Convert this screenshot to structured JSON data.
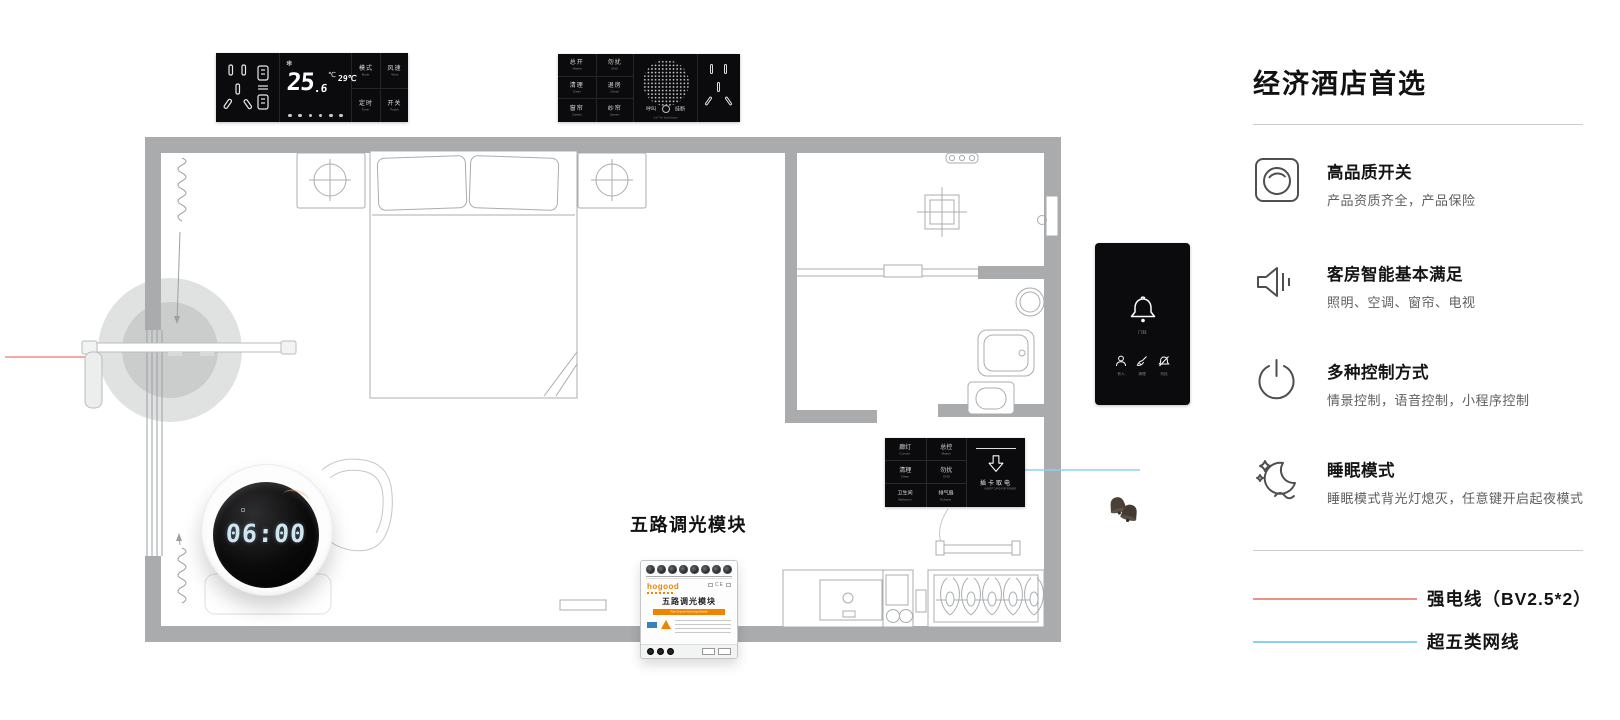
{
  "sidebar": {
    "title": "经济酒店首选",
    "features": [
      {
        "icon": "knob-switch-icon",
        "title": "高品质开关",
        "subtitle": "产品资质齐全，产品保险"
      },
      {
        "icon": "speaker-icon",
        "title": "客房智能基本满足",
        "subtitle": "照明、空调、窗帘、电视"
      },
      {
        "icon": "power-icon",
        "title": "多种控制方式",
        "subtitle": "情景控制，语音控制，小程序控制"
      },
      {
        "icon": "moon-stars-icon",
        "title": "睡眠模式",
        "subtitle": "睡眠模式背光灯熄灭，任意键开启起夜模式"
      }
    ],
    "legend": [
      {
        "label": "强电线（BV2.5*2）",
        "color": "#ef9086"
      },
      {
        "label": "超五类网线",
        "color": "#8fd0ea"
      }
    ]
  },
  "thermostat_panel": {
    "set_temp": "25",
    "set_temp_frac": ".6",
    "unit": "℃",
    "ambient": "29℃",
    "buttons": [
      {
        "zh": "模式",
        "en": "Mode"
      },
      {
        "zh": "风速",
        "en": "Wind"
      },
      {
        "zh": "定时",
        "en": "Timer"
      },
      {
        "zh": "开关",
        "en": "Power"
      }
    ]
  },
  "service_panel": {
    "buttons": [
      {
        "zh": "总开",
        "en": "Master"
      },
      {
        "zh": "勿扰",
        "en": "DND"
      },
      {
        "zh": "清理",
        "en": "Clean"
      },
      {
        "zh": "退房",
        "en": "Check"
      },
      {
        "zh": "窗帘",
        "en": "Curtain"
      },
      {
        "zh": "纱帘",
        "en": "Screen"
      }
    ],
    "call_left": "呼叫",
    "call_right": "挂断",
    "call_note": "Call The Switchboard"
  },
  "door_panel": {
    "bell_label": "门铃",
    "indicators": [
      {
        "label": "有人"
      },
      {
        "label": "清理"
      },
      {
        "label": "勿扰"
      }
    ]
  },
  "card_panel": {
    "buttons": [
      {
        "zh": "廊灯",
        "en": "Corridor"
      },
      {
        "zh": "总控",
        "en": "Master"
      },
      {
        "zh": "清理",
        "en": "Clean"
      },
      {
        "zh": "勿扰",
        "en": "DND"
      },
      {
        "zh": "卫生间",
        "en": "Bathroom"
      },
      {
        "zh": "排气扇",
        "en": "Exhaust"
      }
    ],
    "card_text": "插卡取电",
    "card_text_en": "INSERT CARD FOR POWER"
  },
  "clock": {
    "time": "06:00"
  },
  "dimmer_module": {
    "callout": "五路调光模块",
    "brand": "hogood",
    "cert": "CE",
    "title": "五路调光模块",
    "subtitle": "Five Channel Dimming Module"
  }
}
